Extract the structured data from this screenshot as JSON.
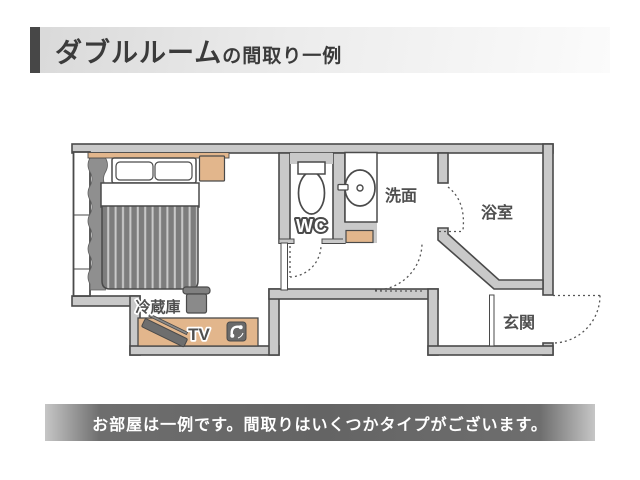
{
  "header": {
    "title_main": "ダブルルーム",
    "title_sub": "の間取り一例"
  },
  "footer": {
    "note": "お部屋は一例です。間取りはいくつかタイプがございます。"
  },
  "floorplan": {
    "labels": {
      "wc": "WC",
      "washroom": "洗面",
      "bathroom": "浴室",
      "entrance": "玄関",
      "fridge": "冷蔵庫",
      "tv": "TV"
    },
    "colors": {
      "wall_fill": "#c9c9c9",
      "outline": "#4a4a4a",
      "furniture_tan": "#e2b68c",
      "blanket_dark": "#7d7d7d",
      "blanket_stripe": "#c9c9c9",
      "curtain_gray": "#8f8f8f",
      "appliance_gray": "#6e6e6e",
      "accent_bar": "#474747",
      "footer_bar": "#646464"
    }
  }
}
